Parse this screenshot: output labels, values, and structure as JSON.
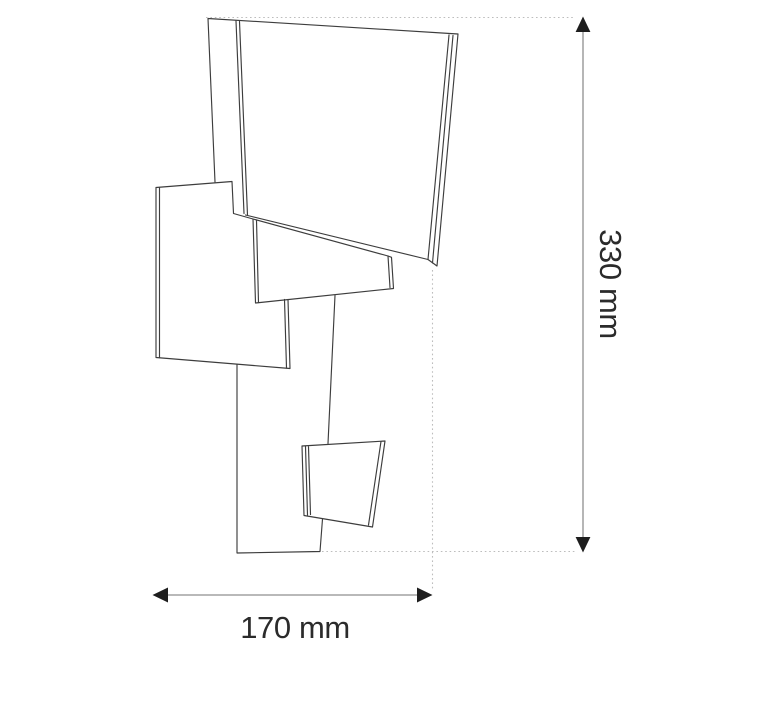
{
  "dimensions": {
    "height": {
      "label": "330 mm",
      "value": 330,
      "unit": "mm"
    },
    "width": {
      "label": "170 mm",
      "value": 170,
      "unit": "mm"
    }
  },
  "colors": {
    "background": "#ffffff",
    "outline": "#3d3d3d",
    "dimension-line": "#8f8f8f",
    "extension-line": "#bdbdbd",
    "arrow": "#1e1e1e",
    "label-text": "#2b2b2b"
  }
}
